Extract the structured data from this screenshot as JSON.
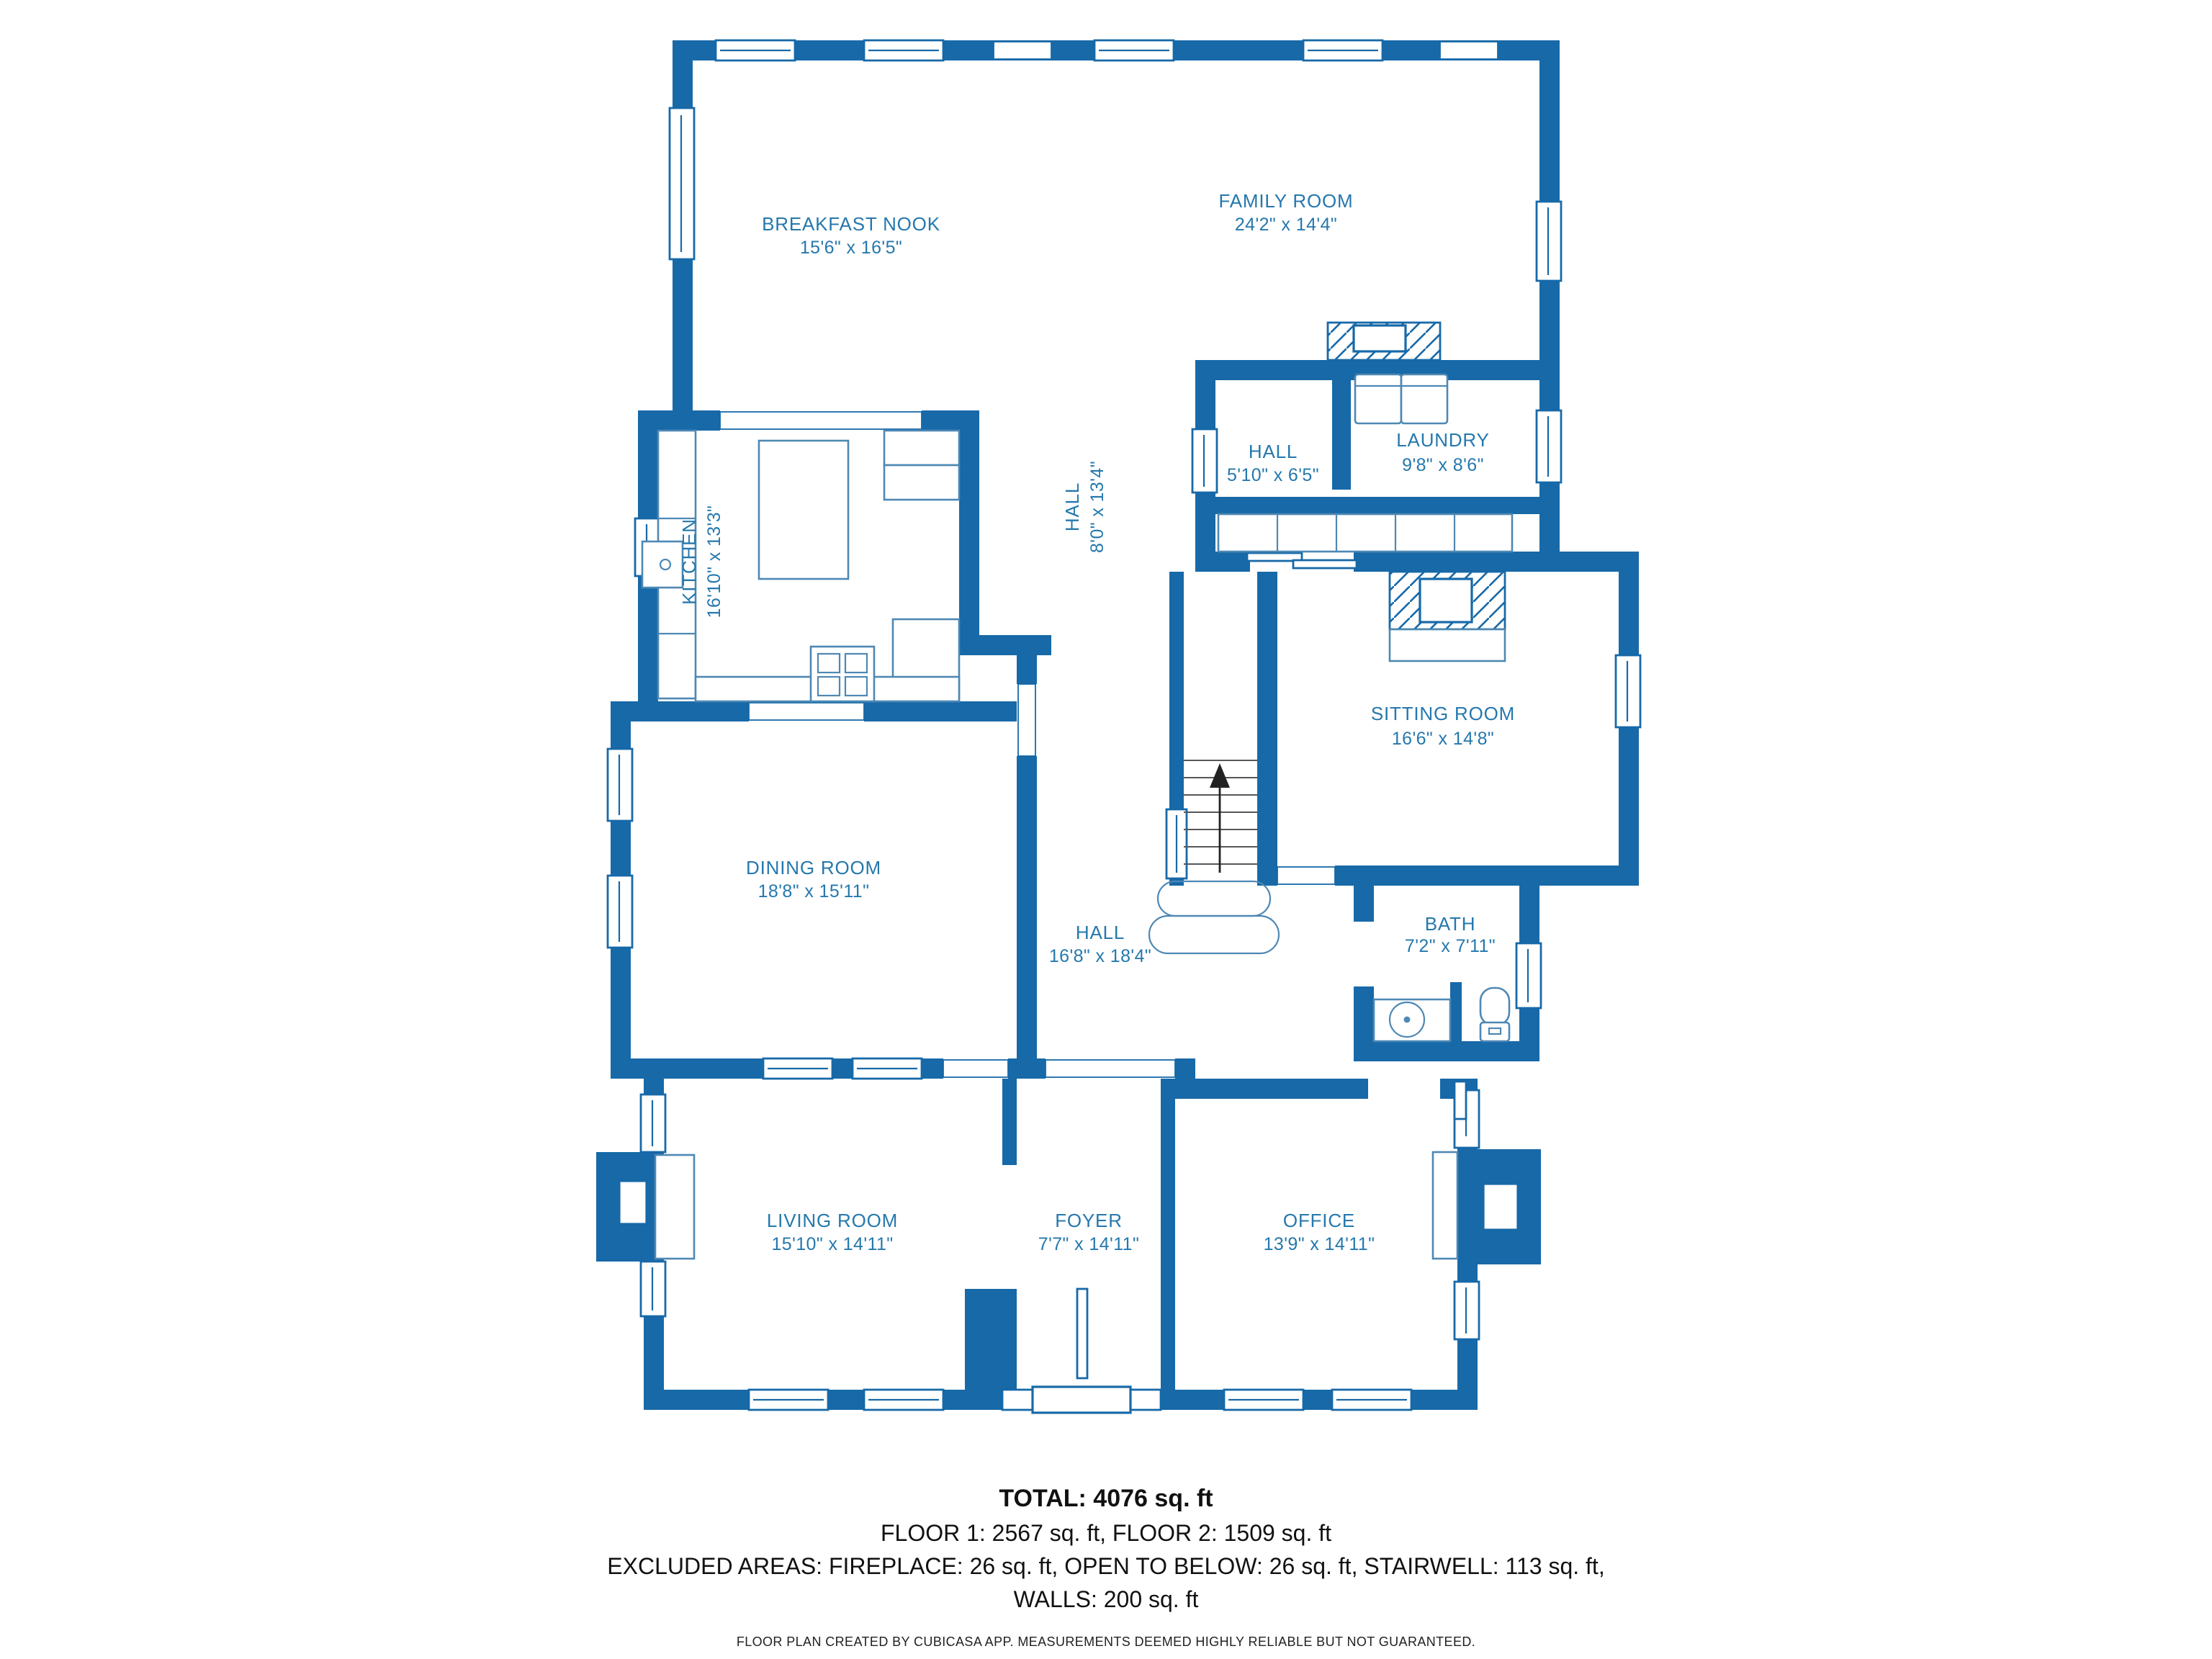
{
  "floorplan": {
    "rooms": [
      {
        "id": "breakfast-nook",
        "name": "BREAKFAST NOOK",
        "dims": "15'6\" x 16'5\""
      },
      {
        "id": "family-room",
        "name": "FAMILY ROOM",
        "dims": "24'2\" x 14'4\""
      },
      {
        "id": "hall-upper",
        "name": "HALL",
        "dims": "5'10\" x 6'5\""
      },
      {
        "id": "laundry",
        "name": "LAUNDRY",
        "dims": "9'8\" x 8'6\""
      },
      {
        "id": "hall-corridor",
        "name": "HALL",
        "dims": "8'0\" x 13'4\""
      },
      {
        "id": "kitchen",
        "name": "KITCHEN",
        "dims": "16'10\" x 13'3\""
      },
      {
        "id": "sitting-room",
        "name": "SITTING ROOM",
        "dims": "16'6\" x 14'8\""
      },
      {
        "id": "dining-room",
        "name": "DINING ROOM",
        "dims": "18'8\" x 15'11\""
      },
      {
        "id": "hall-main",
        "name": "HALL",
        "dims": "16'8\" x 18'4\""
      },
      {
        "id": "bath",
        "name": "BATH",
        "dims": "7'2\" x 7'11\""
      },
      {
        "id": "living-room",
        "name": "LIVING ROOM",
        "dims": "15'10\" x 14'11\""
      },
      {
        "id": "foyer",
        "name": "FOYER",
        "dims": "7'7\" x 14'11\""
      },
      {
        "id": "office",
        "name": "OFFICE",
        "dims": "13'9\" x 14'11\""
      }
    ],
    "summary": {
      "total": "TOTAL: 4076 sq. ft",
      "floors": "FLOOR 1: 2567 sq. ft, FLOOR 2: 1509 sq. ft",
      "excluded": "EXCLUDED AREAS: FIREPLACE: 26 sq. ft, OPEN TO BELOW: 26 sq. ft, STAIRWELL: 113 sq. ft,",
      "walls": "WALLS: 200 sq. ft",
      "disclaimer": "FLOOR PLAN CREATED BY CUBICASA APP. MEASUREMENTS DEEMED HIGHLY RELIABLE BUT NOT GUARANTEED."
    },
    "colors": {
      "wall": "#1769a8",
      "label": "#2578ad"
    }
  }
}
